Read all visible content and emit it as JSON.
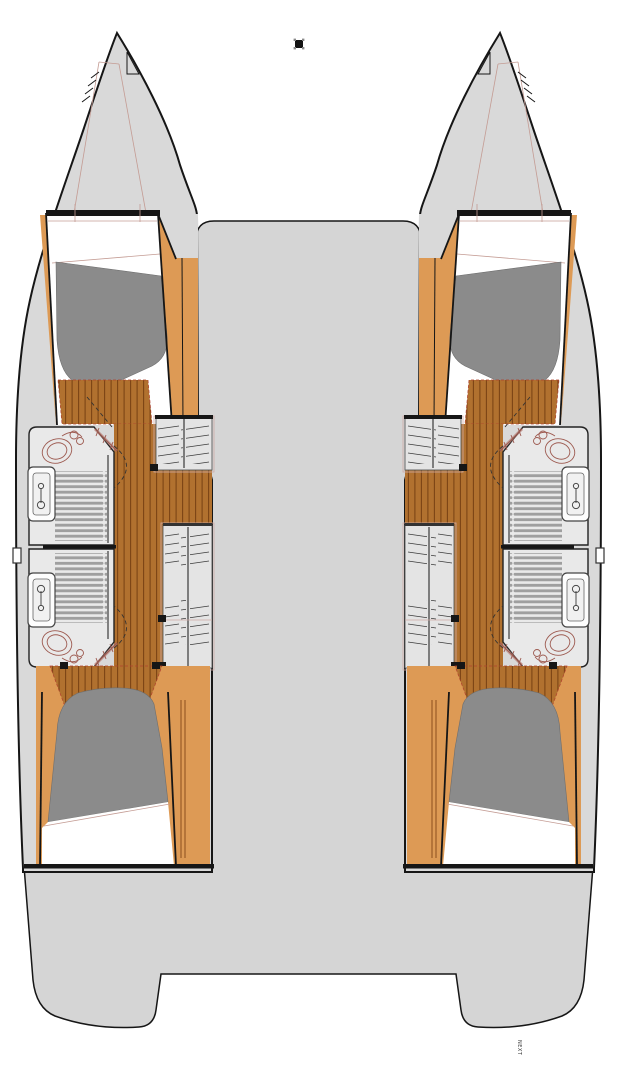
{
  "title": "catamaran-four-cabin-layout-plan",
  "footer": {
    "label": "NEXT"
  },
  "marker": {
    "name": "selection-square-marker"
  },
  "colors": {
    "page": "#ffffff",
    "outline": "#161616",
    "hull": "#d9d9d9",
    "deck": "#d5d5d5",
    "accentWood": "#b1712f",
    "plankLine": "#7c4414",
    "panelOrange": "#dd9a55",
    "duvetGray": "#8b8b8b",
    "roomGray": "#e9e9e9",
    "slatGray": "#9f9f9f",
    "fixtureRed": "#9d5a50",
    "pinkOutline": "#cfaaa5"
  }
}
